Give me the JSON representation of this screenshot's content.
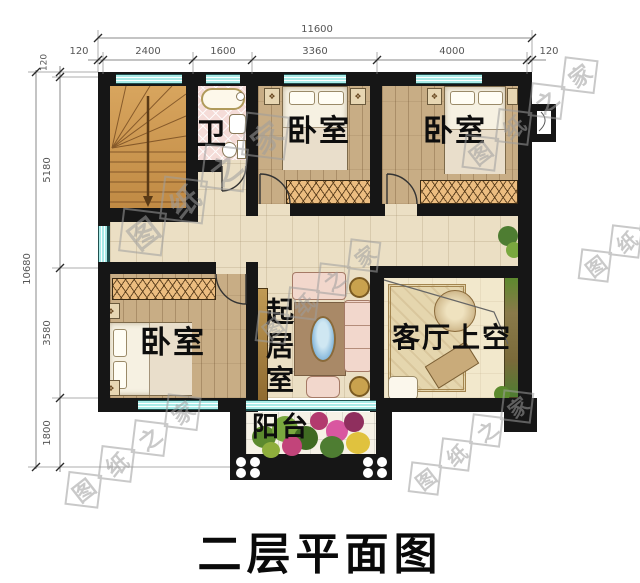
{
  "title": "二层平面图",
  "watermark": {
    "text": "图纸之家",
    "chars": [
      "图",
      "纸",
      "之",
      "家"
    ]
  },
  "rooms": {
    "bath": {
      "label": "卫"
    },
    "bedroom_top_mid": {
      "label": "卧室"
    },
    "bedroom_top_right": {
      "label": "卧室"
    },
    "bedroom_bottom_left": {
      "label": "卧室"
    },
    "sitting": {
      "label": "起居室"
    },
    "living_void": {
      "label": "客厅上空"
    },
    "balcony": {
      "label": "阳台"
    }
  },
  "dimensions": {
    "top": {
      "total": "11600",
      "segments": [
        "120",
        "2400",
        "1600",
        "3360",
        "4000",
        "120"
      ]
    },
    "left": {
      "total": "10680",
      "segments": [
        "120",
        "5180",
        "3580",
        "1800"
      ]
    }
  },
  "colors": {
    "wall": "#161616",
    "window_glass": "#a9ebe8",
    "corridor_floor": "#ebdfc4",
    "wood_floor": "#c8ad85",
    "bath_floor": "#f5dcd8",
    "wardrobe_hatch": "#ecbd80",
    "watermark_gray": "#9e9e9e"
  }
}
